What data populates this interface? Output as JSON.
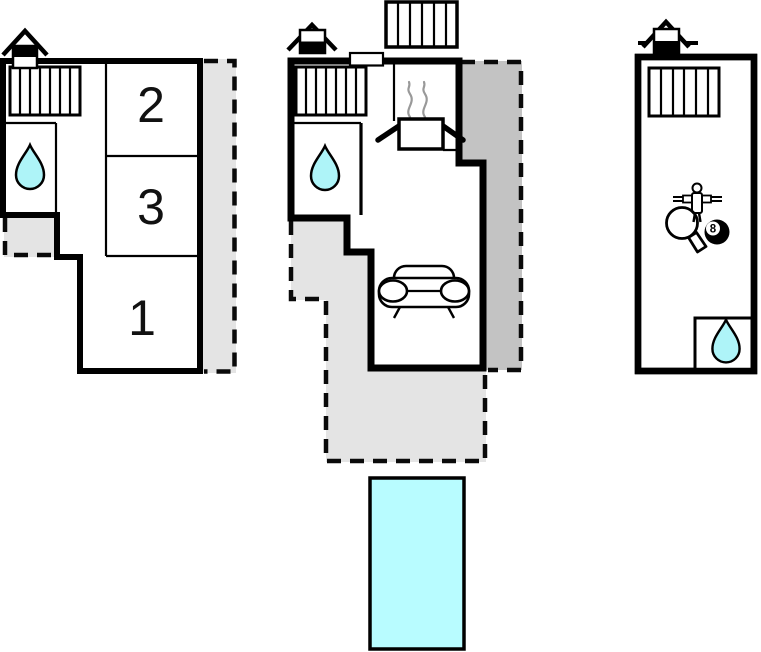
{
  "colors": {
    "wall": "#000000",
    "terrace_light": "#e4e4e4",
    "terrace_dark": "#c3c3c3",
    "water": "#aef4f8",
    "pool": "#b8fcff",
    "green_room": "#c0fdbc",
    "steam": "#999999"
  },
  "units": [
    {
      "position": "left",
      "room_labels": [
        "2",
        "3",
        "1"
      ],
      "icons": [
        "chimney-icon",
        "radiator-icon",
        "water-drop-icon"
      ],
      "terraces": [
        "dashed-light-gray-strip",
        "dashed-light-gray-corner"
      ]
    },
    {
      "position": "middle",
      "room_labels": [],
      "icons": [
        "chimney-icon",
        "radiator-icon",
        "water-drop-icon",
        "stove-icon",
        "steam-icon",
        "sofa-icon",
        "window",
        "roof-hatch"
      ],
      "terraces": [
        "dashed-light-gray-wraparound",
        "dashed-dark-gray-side"
      ],
      "pool": "swimming-pool"
    },
    {
      "position": "right",
      "room_labels": [],
      "icons": [
        "chimney-icon",
        "radiator-icon",
        "foosball-icon",
        "table-tennis-paddle-icon",
        "billiard-ball-icon",
        "water-drop-icon"
      ],
      "billiard_ball_label": "8",
      "terraces": []
    }
  ]
}
